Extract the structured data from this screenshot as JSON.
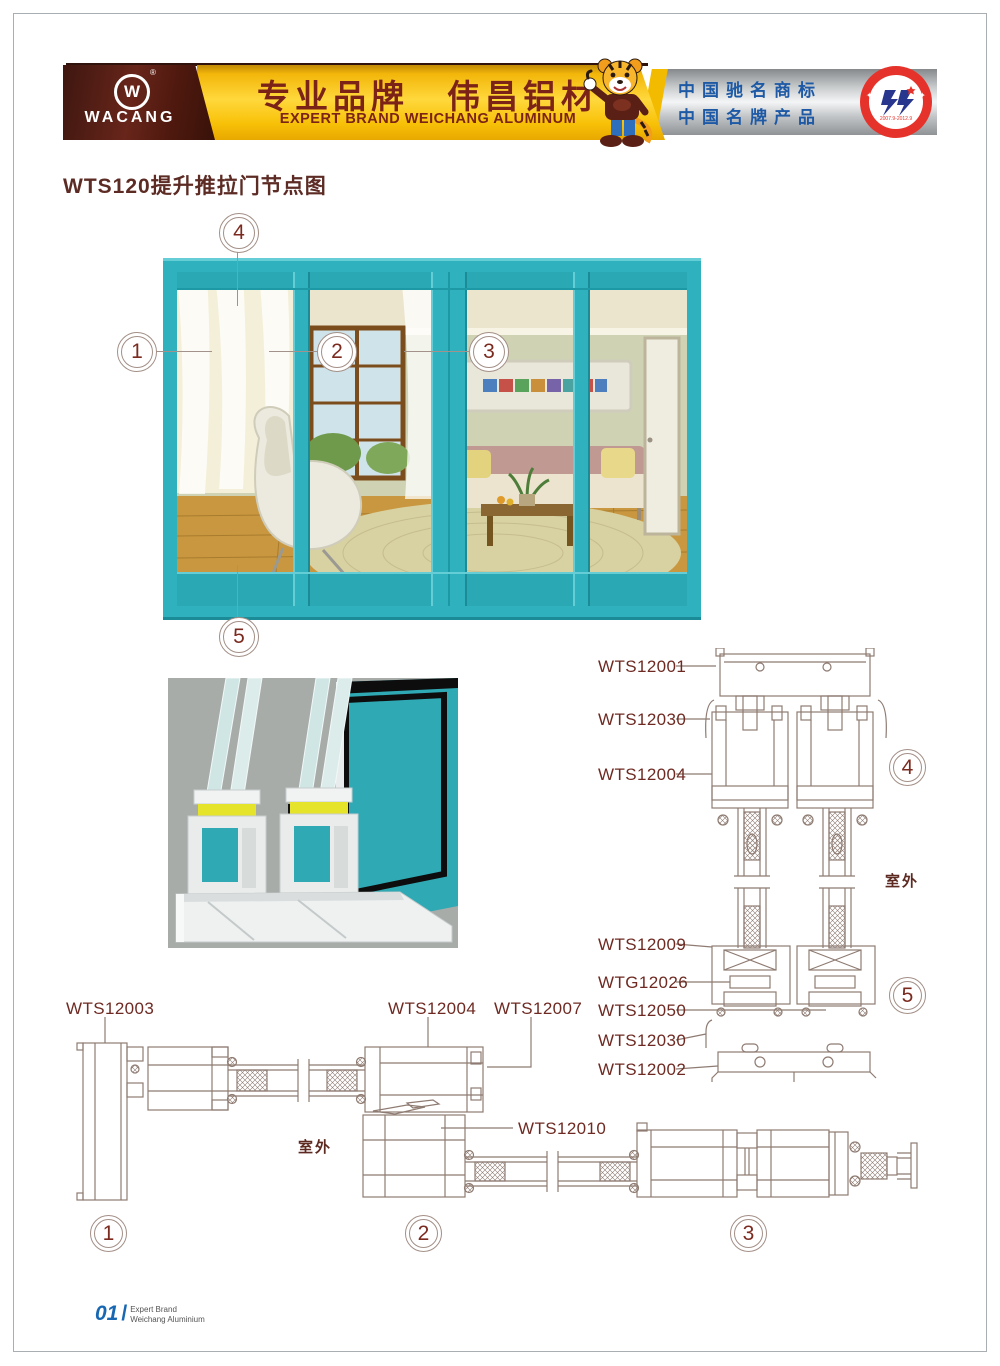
{
  "header": {
    "logo": {
      "brand": "WACANG",
      "mark": "W",
      "registered": "®"
    },
    "banner": {
      "title_cn": "专业品牌　伟昌铝材",
      "title_en": "EXPERT BRAND WEICHANG ALUMINUM"
    },
    "honors": {
      "line1": "中国驰名商标",
      "line2": "中国名牌产品"
    },
    "badge": {
      "arc_top": "中国名牌",
      "arc_bottom": "CHINA TOP BRAND",
      "dates": "2007.9-2012.9"
    },
    "colors": {
      "maroon": "#5a1f15",
      "yellow": "#ffd83c",
      "silver": "#f4f5f6",
      "honor_blue": "#1d59a5",
      "badge_red": "#e5332b"
    }
  },
  "page": {
    "title": "WTS120提升推拉门节点图"
  },
  "door": {
    "frame_color": "#2fb2bd"
  },
  "callouts": {
    "c1": "1",
    "c2": "2",
    "c3": "3",
    "c4": "4",
    "c5": "5"
  },
  "sections": {
    "vertical": {
      "labels": [
        "WTS12001",
        "WTS12030",
        "WTS12004",
        "WTS12009",
        "WTG12026",
        "WTS12050",
        "WTS12030",
        "WTS12002"
      ],
      "outdoor": "室外",
      "detail_top": "4",
      "detail_bottom": "5"
    },
    "horizontal": {
      "labels": [
        "WTS12003",
        "WTS12004",
        "WTS12007",
        "WTS12010"
      ],
      "outdoor": "室外",
      "details": [
        "1",
        "2",
        "3"
      ]
    }
  },
  "footer": {
    "page_no": "01",
    "slash": "/",
    "line1": "Expert Brand",
    "line2": "Weichang Aluminium"
  }
}
